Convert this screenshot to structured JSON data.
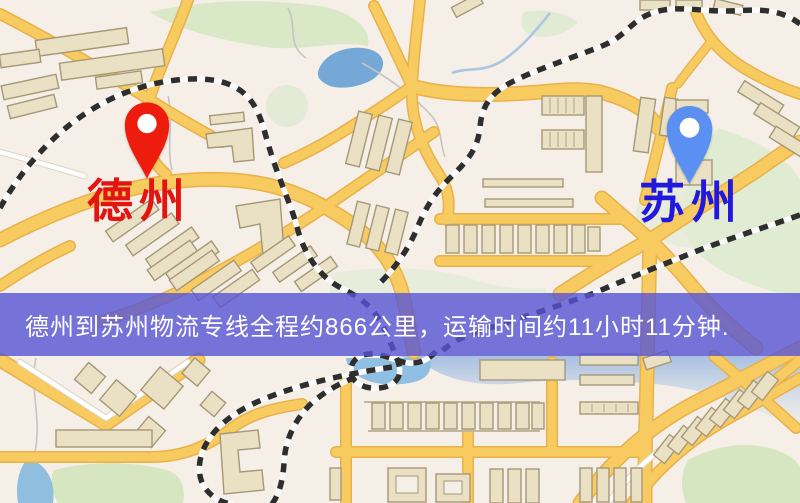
{
  "map_view": {
    "origin": {
      "label": "德州",
      "pin_color": "#ed1c0d",
      "label_color": "#e31511"
    },
    "destination": {
      "label": "苏州",
      "pin_color": "#5b8ff2",
      "label_color": "#2219dd"
    },
    "info_banner": {
      "text": "德州到苏州物流专线全程约866公里，运输时间约11小时11分钟.",
      "background_color": "#5654d4",
      "text_color": "#ffffff"
    },
    "route_facts": {
      "origin_city": "德州",
      "destination_city": "苏州",
      "distance_text": "约866公里",
      "duration_text": "约11小时11分钟"
    },
    "palette": {
      "background": "#f5efe7",
      "road_fill": "#f7cb60",
      "road_casing": "#e9b14a",
      "building": "#eae0c4",
      "park": "#d9e8c6",
      "water": "#8fc0e4",
      "railway": "#2e2e2e"
    }
  }
}
